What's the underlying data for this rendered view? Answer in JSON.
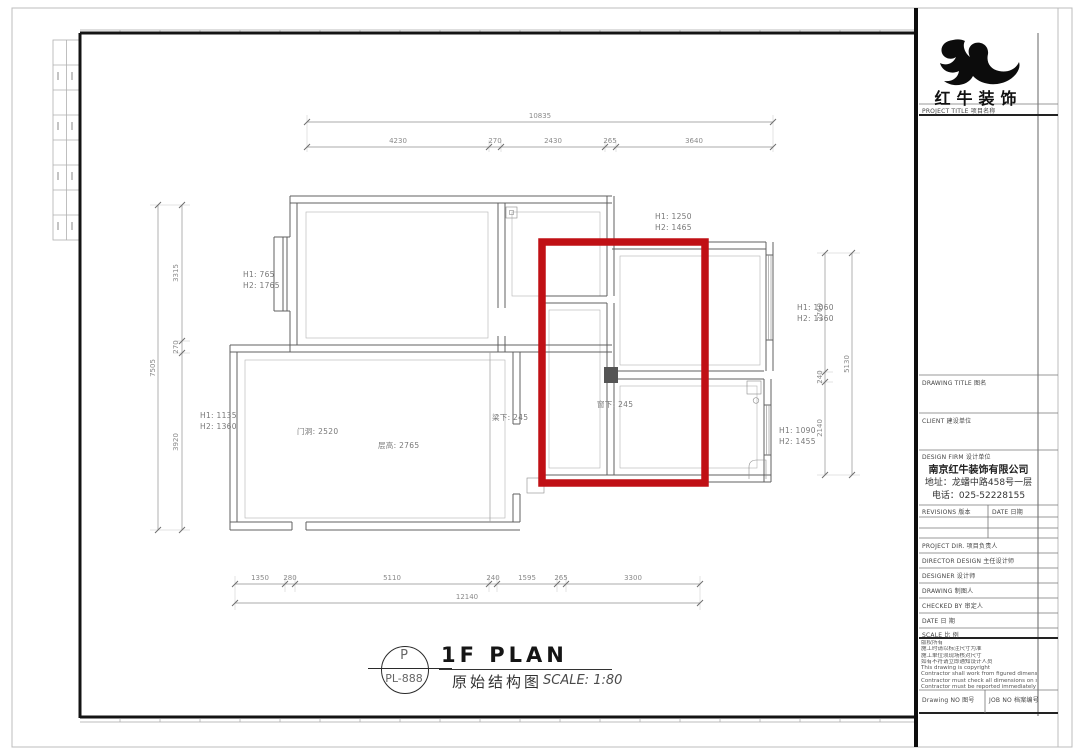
{
  "sheet": {
    "brand": "红牛装饰",
    "project_title_label": "PROJECT TITLE 项目名称",
    "drawing_title_label": "DRAWING TITLE 图名",
    "client_label": "CLIENT 建设单位",
    "design_firm_label": "DESIGN FIRM 设计单位",
    "company_name": "南京红牛装饰有限公司",
    "company_address": "地址：龙蟠中路458号一层",
    "company_phone": "电话：025-52228155",
    "revisions_label": "REVISIONS 版本",
    "revisions_date_label": "DATE 日期",
    "info_rows": [
      "PROJECT DIR.  项目负责人",
      "DIRECTOR DESIGN  主任设计师",
      "DESIGNER  设计师",
      "DRAWING  制图人",
      "CHECKED BY  审定人",
      "DATE  日  期",
      "SCALE  比  例"
    ],
    "notes_cn": [
      "版权所有",
      "施工时请以标注尺寸为准",
      "施工单位须现场核对尺寸",
      "如有不符请立即通知设计人员"
    ],
    "notes_en": [
      "This drawing is copyright",
      "Contractor shall work from figured dimensions only",
      "Contractor must check all dimensions on site",
      "Contractor must be reported immediately to architects"
    ],
    "drawing_no_label": "Drawing NO 图号",
    "job_no_label": "JOB NO 档案编号"
  },
  "titlebar": {
    "ref_letter": "P",
    "ref_code": "PL-888",
    "title": "1F PLAN",
    "subtitle": "原始结构图",
    "scale": "SCALE: 1:80"
  },
  "plan": {
    "highlight_color": "#c01015",
    "dims": {
      "top_total": "10835",
      "top": [
        "4230",
        "270",
        "2430",
        "265",
        "3640"
      ],
      "left_total": "7505",
      "left": [
        "3315",
        "270",
        "3920"
      ],
      "right_total": "5130",
      "right": [
        "2760",
        "240",
        "2140"
      ],
      "bottom_total": "12140",
      "bottom": [
        "1350",
        "280",
        "5110",
        "240",
        "1595",
        "265",
        "3300"
      ]
    },
    "labels": {
      "h_topleft1": "H1: 765",
      "h_topleft2": "H2: 1765",
      "h_topmid1": "H1: 1250",
      "h_topmid2": "H2: 1465",
      "h_right1": "H1: 1060",
      "h_right2": "H2: 1360",
      "h_bottomright1": "H1: 1090",
      "h_bottomright2": "H2: 1455",
      "h_left1": "H1: 1135",
      "h_left2": "H2: 1360",
      "door_opening": "门洞: 2520",
      "ceiling_height": "层高: 2765",
      "under_beam": "梁下: 245",
      "under_window": "窗下: 245"
    }
  }
}
